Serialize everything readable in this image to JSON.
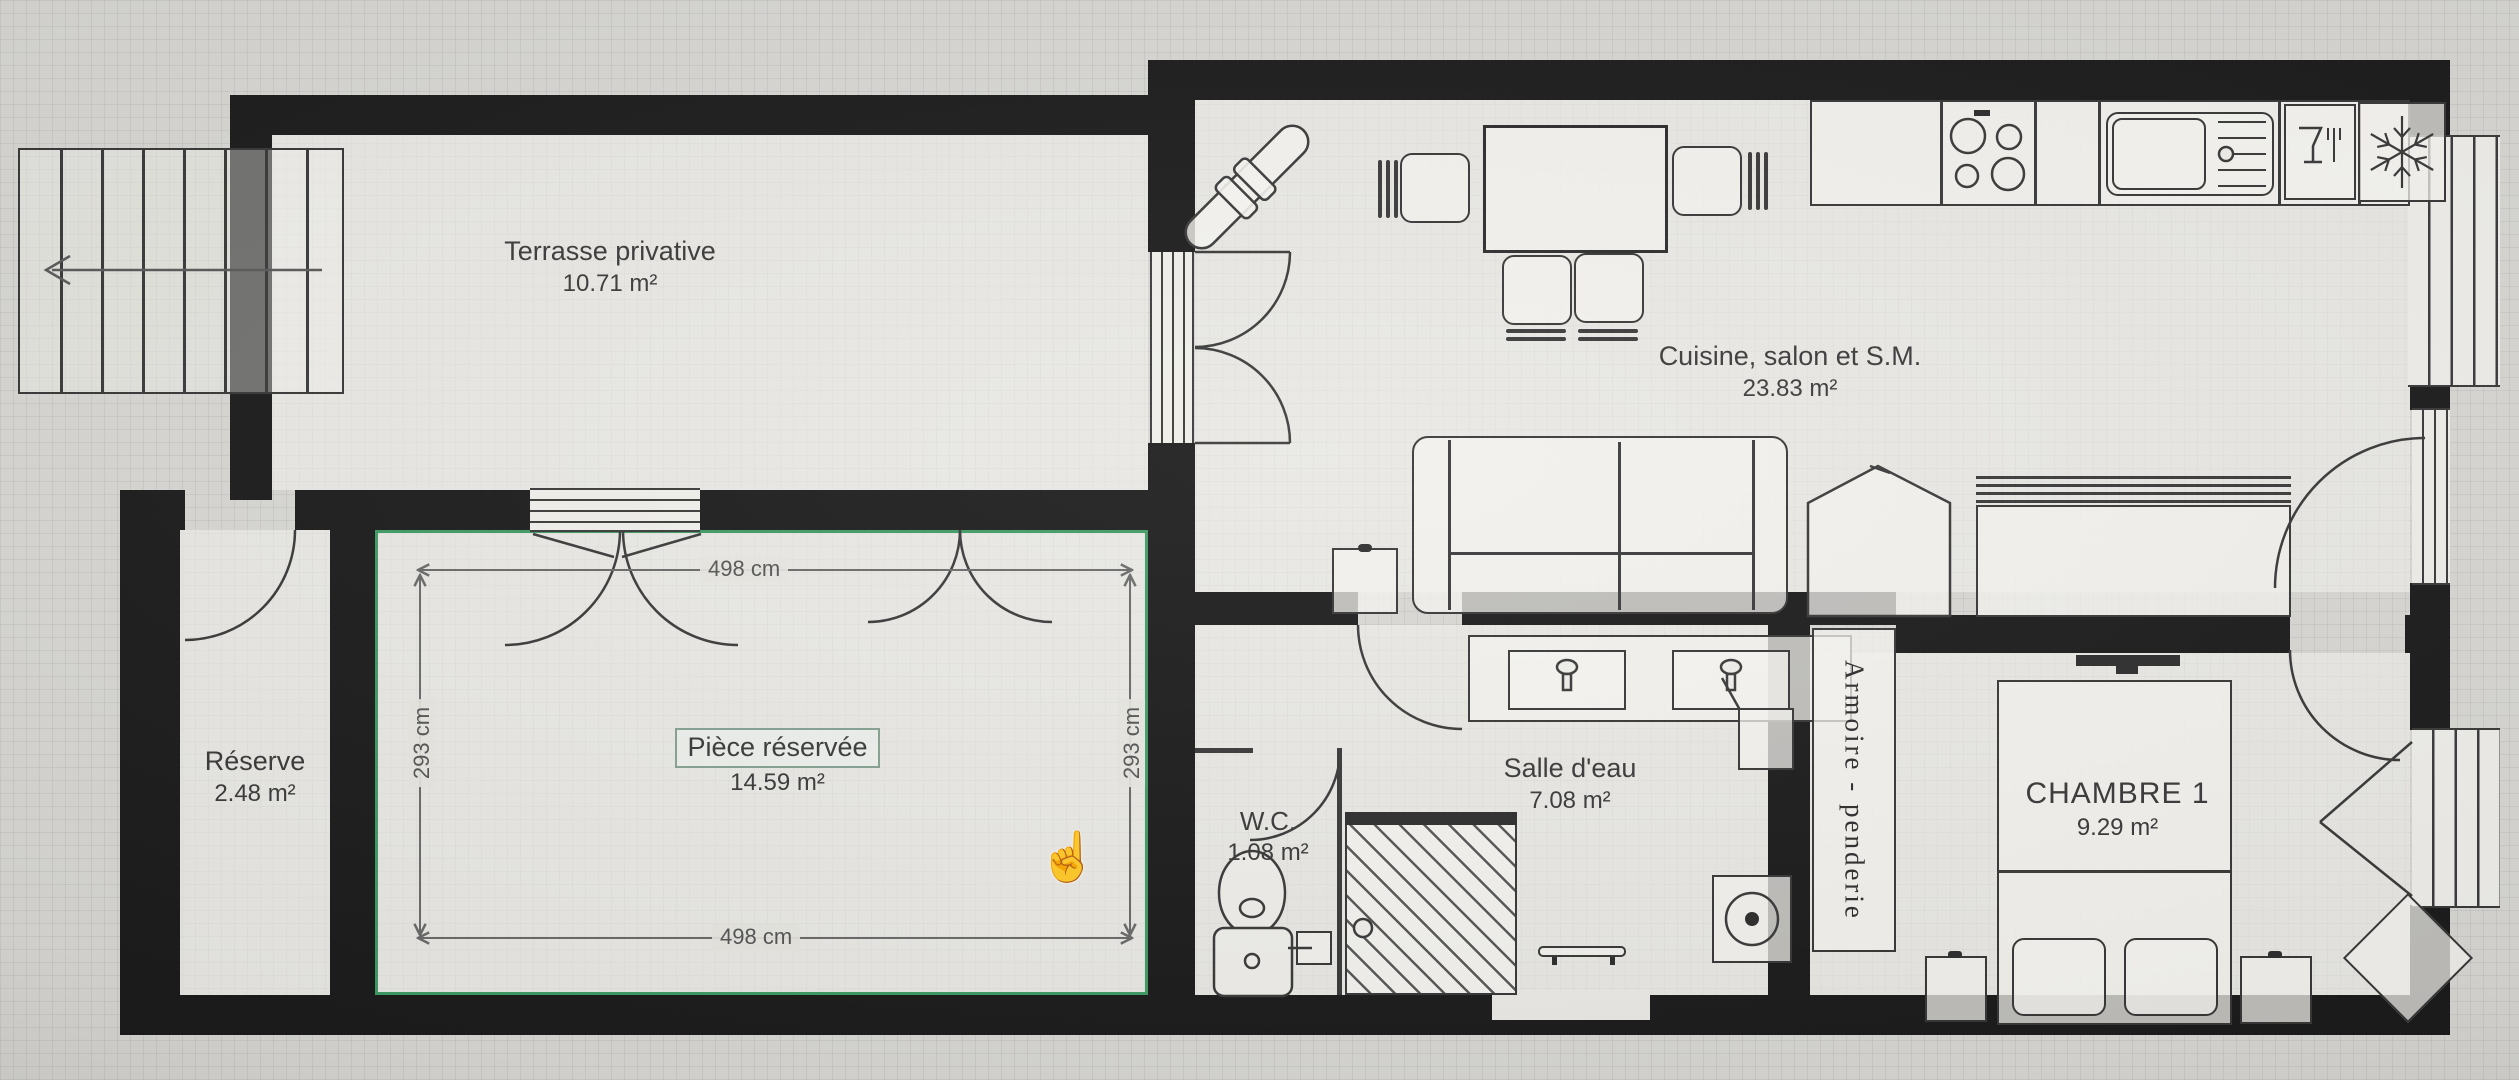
{
  "plan": {
    "rooms": {
      "terrasse": {
        "label": "Terrasse privative",
        "area": "10.71 m²"
      },
      "cuisine": {
        "label": "Cuisine, salon et S.M.",
        "area": "23.83 m²"
      },
      "reserve": {
        "label": "Réserve",
        "area": "2.48 m²"
      },
      "piece_reservee": {
        "label": "Pièce réservée",
        "area": "14.59 m²",
        "state": "selected"
      },
      "wc": {
        "label": "W.C.",
        "area": "1.08 m²"
      },
      "salle_eau": {
        "label": "Salle d'eau",
        "area": "7.08 m²"
      },
      "armoire": {
        "label": "Armoire - penderie"
      },
      "chambre1": {
        "label": "CHAMBRE 1",
        "area": "9.29 m²"
      }
    },
    "dimensions": {
      "piece_width_top": "498 cm",
      "piece_width_bottom": "498 cm",
      "piece_height_left": "293 cm",
      "piece_height_right": "293 cm"
    },
    "cursor": {
      "type": "hand-pointer",
      "glyph": "☝"
    },
    "colors": {
      "wall": "#1C1C1C",
      "line": "#3A3A3A",
      "selection": "#3F9B64",
      "paper": "#D8D7D3"
    }
  }
}
